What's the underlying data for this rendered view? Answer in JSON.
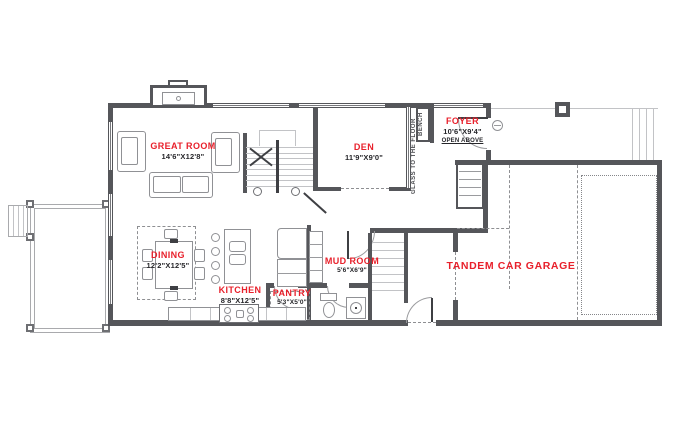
{
  "colors": {
    "accent_red": "#E8202B",
    "wall_gray": "#55565A",
    "line_gray": "#9A9B9E",
    "dim_text": "#26262A"
  },
  "rooms": {
    "great_room": {
      "name": "GREAT ROOM",
      "dims": "14'6\"X12'8\""
    },
    "den": {
      "name": "DEN",
      "dims": "11'9\"X9'0\""
    },
    "foyer": {
      "name": "FOYER",
      "dims": "10'6\"X9'4\"",
      "note": "OPEN ABOVE"
    },
    "dining": {
      "name": "DINING",
      "dims": "12'2\"X12'5\""
    },
    "kitchen": {
      "name": "KITCHEN",
      "dims": "8'8\"X12'5\""
    },
    "pantry": {
      "name": "PANTRY",
      "dims": "5'3\"X5'0\""
    },
    "mud_room": {
      "name": "MUD ROOM",
      "dims": "5'6\"X6'9\""
    },
    "garage": {
      "name": "TANDEM CAR GARAGE"
    }
  },
  "annotations": {
    "bench": "BENCH",
    "glass": "GLASS TO THE FLOOR"
  }
}
